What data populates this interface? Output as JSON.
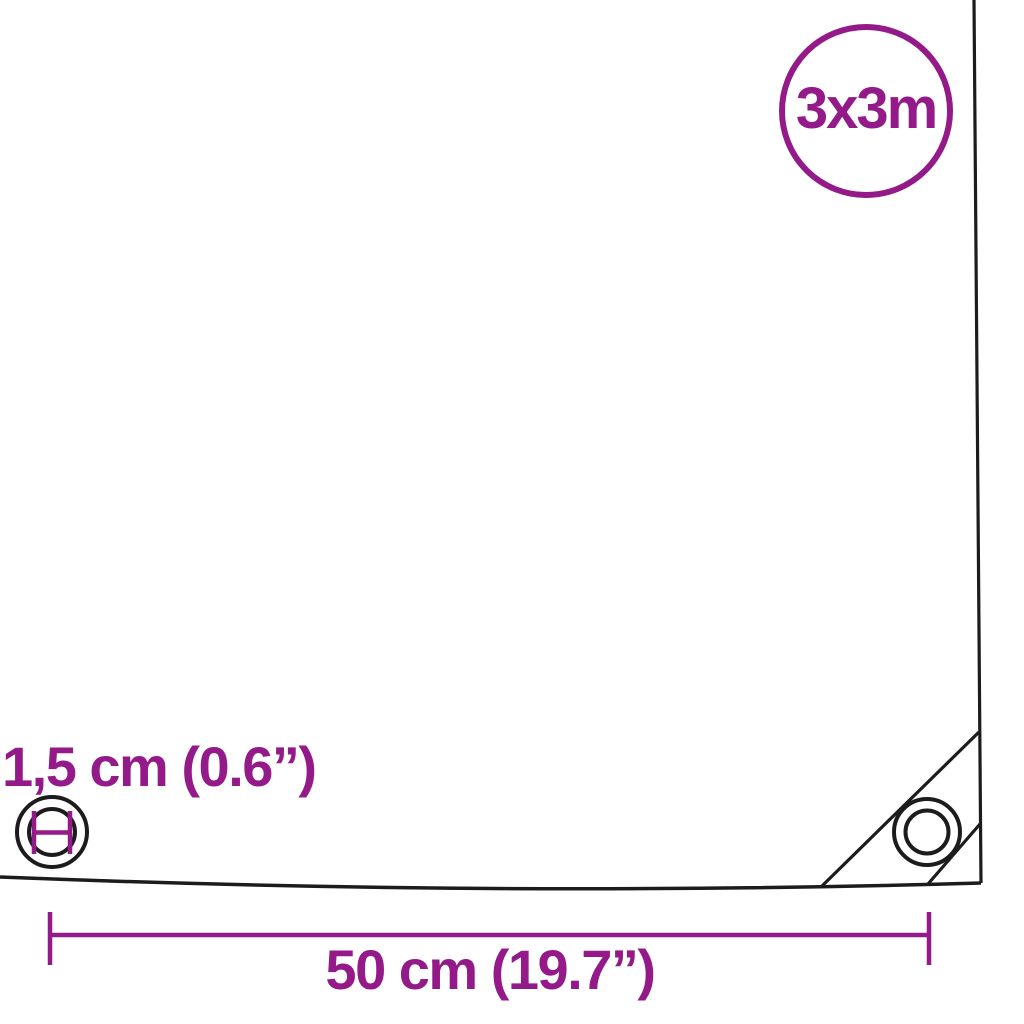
{
  "badge": {
    "size_label": "3x3m"
  },
  "annotations": {
    "eyelet_diameter_label": "1,5 cm (0.6”)",
    "eyelet_spacing_label": "50 cm (19.7”)"
  },
  "colors": {
    "accent_purple": "#931a88",
    "line_black": "#1c1c1c"
  },
  "icons": {
    "left_eyelet": "eyelet-with-diameter-marker-icon",
    "corner_eyelet": "corner-eyelet-icon",
    "badge": "size-badge-circle"
  }
}
